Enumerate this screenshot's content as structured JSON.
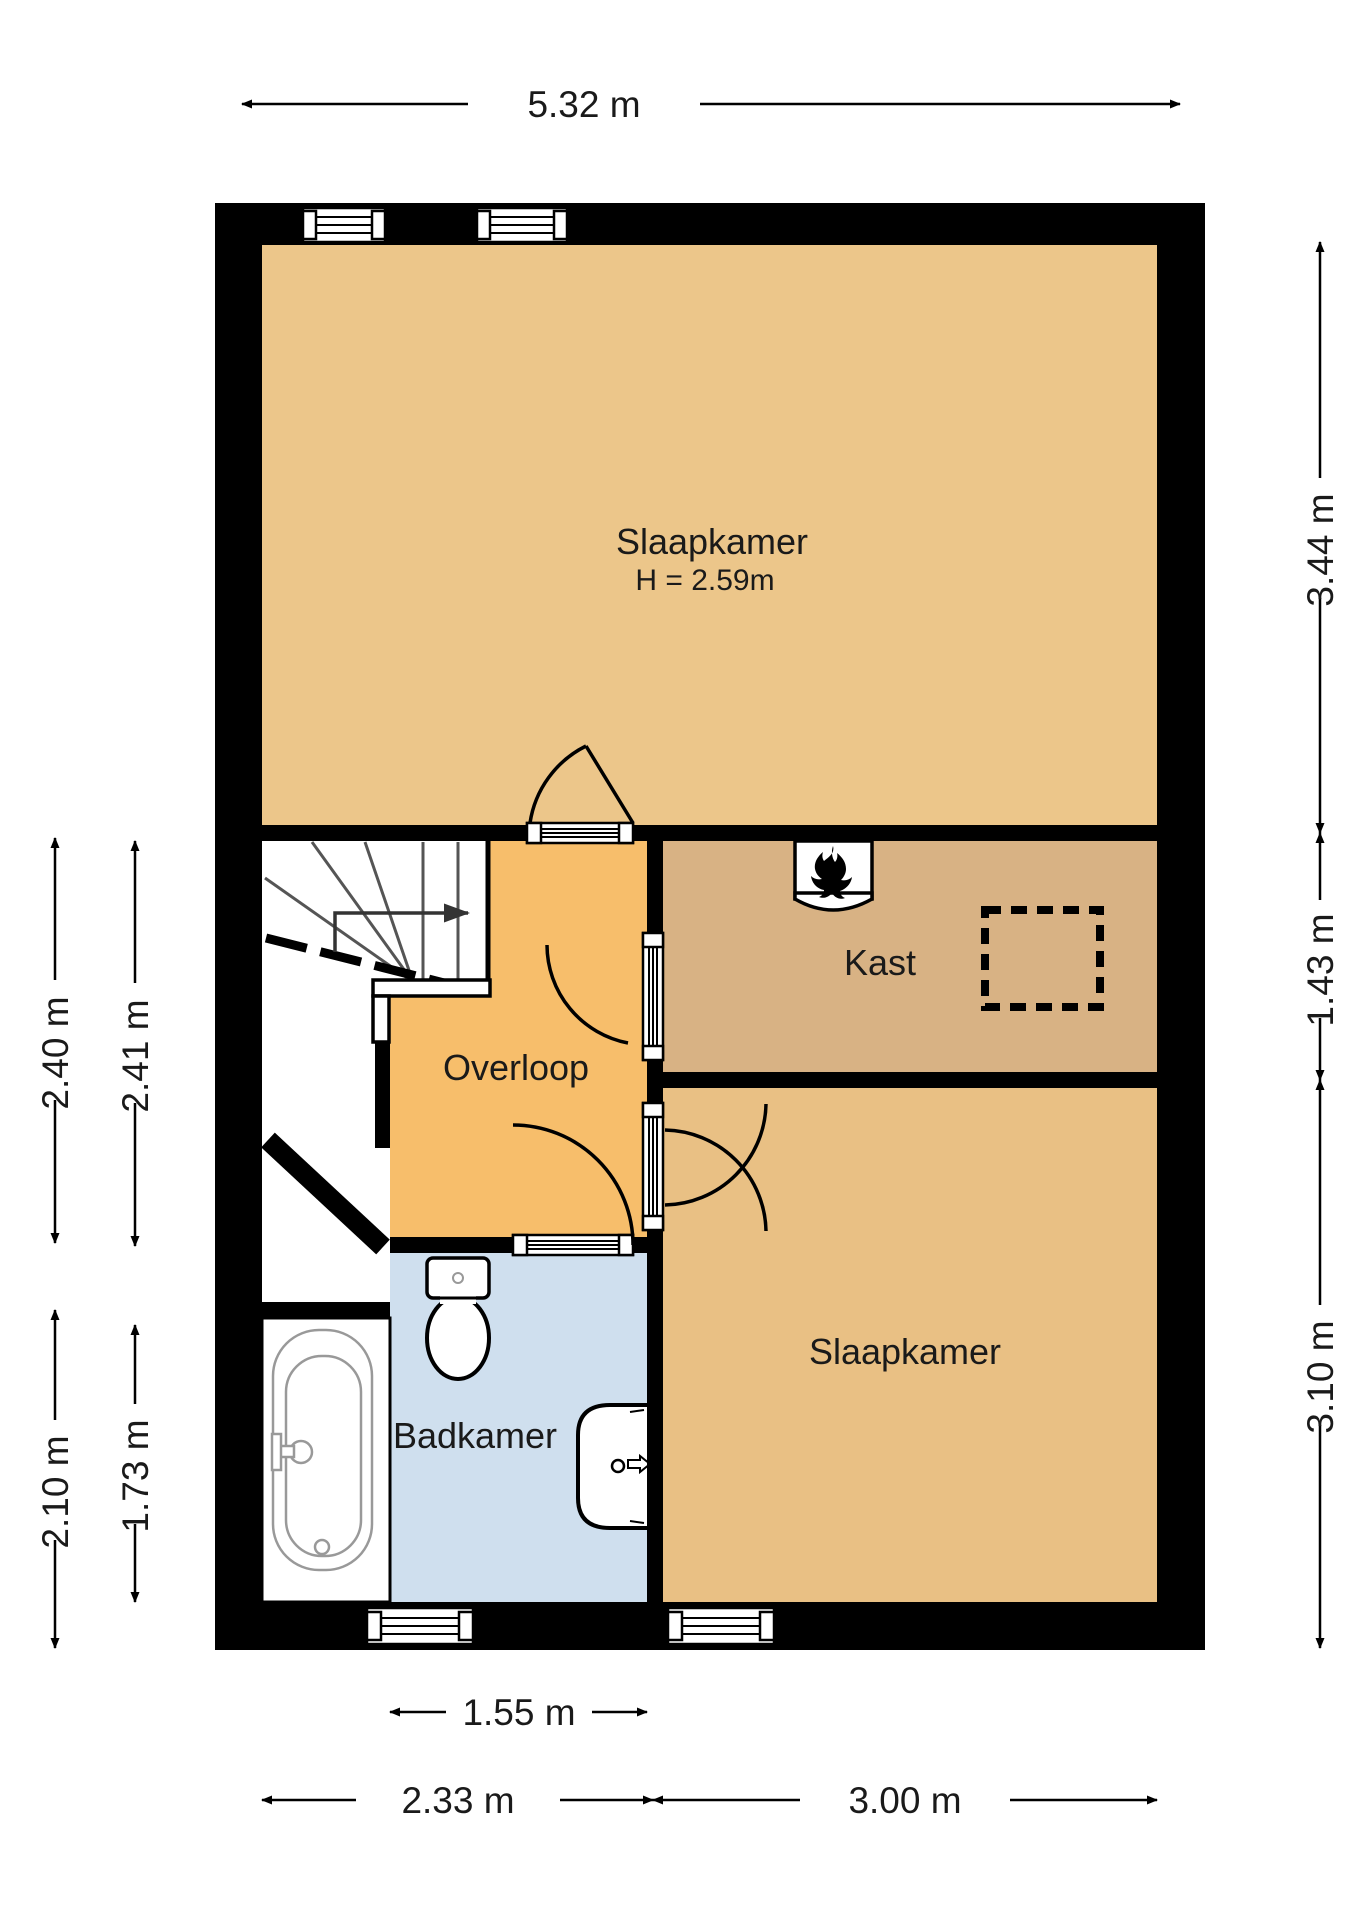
{
  "floorplan": {
    "title": "first-floor plan",
    "rooms": {
      "slaapkamer_top": {
        "label": "Slaapkamer",
        "height_note": "H = 2.59m",
        "color": "#ecc68a"
      },
      "kast": {
        "label": "Kast",
        "color": "#d8b284"
      },
      "overloop": {
        "label": "Overloop",
        "color": "#f7be6b"
      },
      "badkamer": {
        "label": "Badkamer",
        "color": "#cfdfee"
      },
      "slaapkamer_bottom": {
        "label": "Slaapkamer",
        "color": "#e9c084"
      }
    },
    "dimensions": {
      "top_width": "5.32 m",
      "right_top": "3.44 m",
      "right_middle": "1.43 m",
      "right_bottom": "3.10 m",
      "left_outer_upper": "2.40 m",
      "left_inner_upper": "2.41 m",
      "left_outer_lower": "2.10 m",
      "left_inner_lower": "1.73 m",
      "bottom_badkamer": "1.55 m",
      "bottom_left": "2.33 m",
      "bottom_right": "3.00 m"
    },
    "icons": {
      "boiler": "flame-icon",
      "stair_direction": "arrow-right-icon"
    },
    "wall_color": "#000000",
    "fixtures": [
      "staircase",
      "bathtub",
      "toilet",
      "sink",
      "boiler",
      "dashed-floor-hatch"
    ]
  }
}
